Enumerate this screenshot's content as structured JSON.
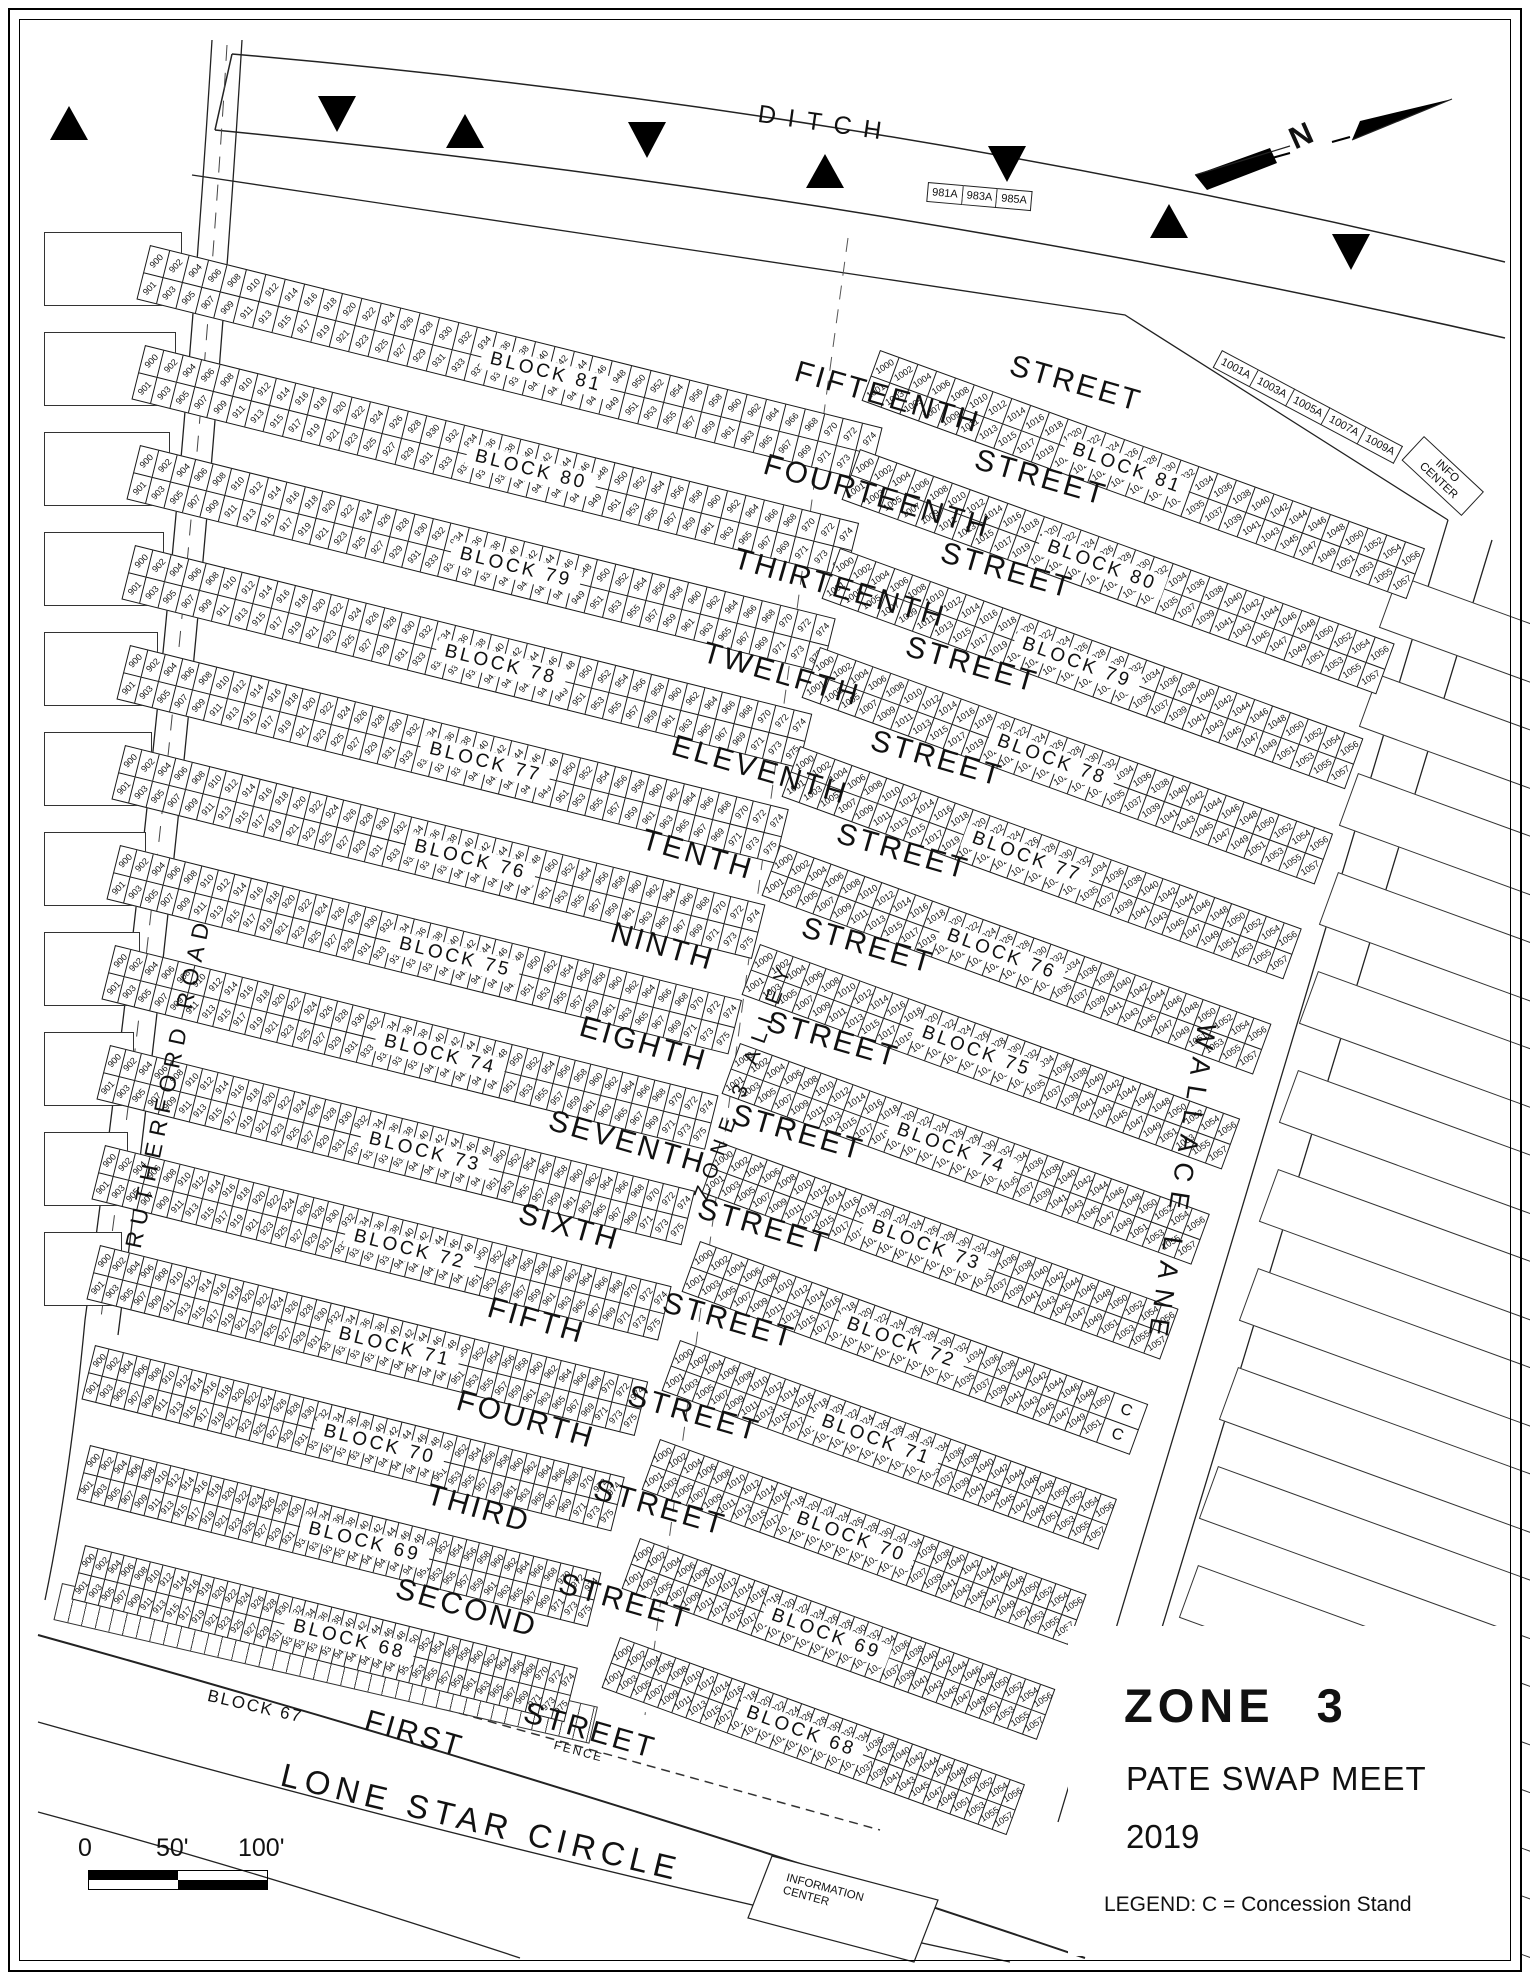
{
  "map": {
    "title": "ZONE 3",
    "subtitle": "PATE SWAP MEET",
    "year": "2019",
    "legend": "LEGEND:  C = Concession Stand",
    "north_label": "N"
  },
  "roads": {
    "ditch": "DITCH",
    "rutherford": "RUTHERFORD ROAD",
    "wallace": "WALLACE LANE",
    "lone_star": "LONE STAR CIRCLE",
    "alley": "ZONE 3 ALLEY",
    "fence": "FENCE"
  },
  "labels": {
    "info_center": [
      "INFO",
      "CENTER"
    ],
    "information_center": [
      "INFORMATION",
      "CENTER"
    ],
    "block67": "BLOCK 67",
    "concession": "C"
  },
  "markers": {
    "west": [
      "981A",
      "983A",
      "985A"
    ],
    "east": [
      "1001A",
      "1003A",
      "1005A",
      "1007A",
      "1009A"
    ]
  },
  "scale_bar": {
    "labels": [
      "0",
      "50'",
      "100'"
    ]
  },
  "streets": {
    "suffix": "STREET",
    "names": [
      "FIFTEENTH",
      "FOURTEENTH",
      "THIRTEENTH",
      "TWELFTH",
      "ELEVENTH",
      "TENTH",
      "NINTH",
      "EIGHTH",
      "SEVENTH",
      "SIXTH",
      "FIFTH",
      "FOURTH",
      "THIRD",
      "SECOND",
      "FIRST"
    ]
  },
  "west_blocks": [
    {
      "label": "BLOCK 81",
      "even_start": 900,
      "even_end": 974,
      "odd_start": 901,
      "odd_end": 975
    },
    {
      "label": "BLOCK 80",
      "even_start": 900,
      "even_end": 974,
      "odd_start": 901,
      "odd_end": 975
    },
    {
      "label": "BLOCK 79",
      "even_start": 900,
      "even_end": 974,
      "odd_start": 901,
      "odd_end": 975
    },
    {
      "label": "BLOCK 78",
      "even_start": 900,
      "even_end": 974,
      "odd_start": 901,
      "odd_end": 975
    },
    {
      "label": "BLOCK 77",
      "even_start": 900,
      "even_end": 974,
      "odd_start": 901,
      "odd_end": 975
    },
    {
      "label": "BLOCK 76",
      "even_start": 900,
      "even_end": 974,
      "odd_start": 901,
      "odd_end": 975
    },
    {
      "label": "BLOCK 75",
      "even_start": 900,
      "even_end": 974,
      "odd_start": 901,
      "odd_end": 975
    },
    {
      "label": "BLOCK 74",
      "even_start": 900,
      "even_end": 974,
      "odd_start": 901,
      "odd_end": 975
    },
    {
      "label": "BLOCK 73",
      "even_start": 900,
      "even_end": 974,
      "odd_start": 901,
      "odd_end": 975
    },
    {
      "label": "BLOCK 72",
      "even_start": 900,
      "even_end": 974,
      "odd_start": 901,
      "odd_end": 975
    },
    {
      "label": "BLOCK 71",
      "even_start": 900,
      "even_end": 974,
      "odd_start": 901,
      "odd_end": 975
    },
    {
      "label": "BLOCK 70",
      "even_start": 900,
      "even_end": 974,
      "odd_start": 901,
      "odd_end": 975
    },
    {
      "label": "BLOCK 69",
      "even_start": 900,
      "even_end": 974,
      "odd_start": 901,
      "odd_end": 975
    },
    {
      "label": "BLOCK 68",
      "even_start": 900,
      "even_end": 974,
      "odd_start": 901,
      "odd_end": 975
    }
  ],
  "east_blocks": [
    {
      "label": "BLOCK 81",
      "even_start": 1000,
      "even_end": 1056,
      "odd_start": 1001,
      "odd_end": 1057
    },
    {
      "label": "BLOCK 80",
      "even_start": 1000,
      "even_end": 1056,
      "odd_start": 1001,
      "odd_end": 1057
    },
    {
      "label": "BLOCK 79",
      "even_start": 1000,
      "even_end": 1056,
      "odd_start": 1001,
      "odd_end": 1057
    },
    {
      "label": "BLOCK 78",
      "even_start": 1000,
      "even_end": 1056,
      "odd_start": 1001,
      "odd_end": 1057
    },
    {
      "label": "BLOCK 77",
      "even_start": 1000,
      "even_end": 1056,
      "odd_start": 1001,
      "odd_end": 1057
    },
    {
      "label": "BLOCK 76",
      "even_start": 1000,
      "even_end": 1056,
      "odd_start": 1001,
      "odd_end": 1057
    },
    {
      "label": "BLOCK 75",
      "even_start": 1000,
      "even_end": 1056,
      "odd_start": 1001,
      "odd_end": 1057
    },
    {
      "label": "BLOCK 74",
      "even_start": 1000,
      "even_end": 1056,
      "odd_start": 1001,
      "odd_end": 1057
    },
    {
      "label": "BLOCK 73",
      "even_start": 1000,
      "even_end": 1056,
      "odd_start": 1001,
      "odd_end": 1057
    },
    {
      "label": "BLOCK 72",
      "even_start": 1000,
      "even_end": 1050,
      "odd_start": 1001,
      "odd_end": 1051,
      "concession_cells": 2
    },
    {
      "label": "BLOCK 71",
      "even_start": 1000,
      "even_end": 1056,
      "odd_start": 1001,
      "odd_end": 1057
    },
    {
      "label": "BLOCK 70",
      "even_start": 1000,
      "even_end": 1056,
      "odd_start": 1001,
      "odd_end": 1057
    },
    {
      "label": "BLOCK 69",
      "even_start": 1000,
      "even_end": 1056,
      "odd_start": 1001,
      "odd_end": 1057
    },
    {
      "label": "BLOCK 68",
      "even_start": 1000,
      "even_end": 1056,
      "odd_start": 1001,
      "odd_end": 1057
    }
  ]
}
